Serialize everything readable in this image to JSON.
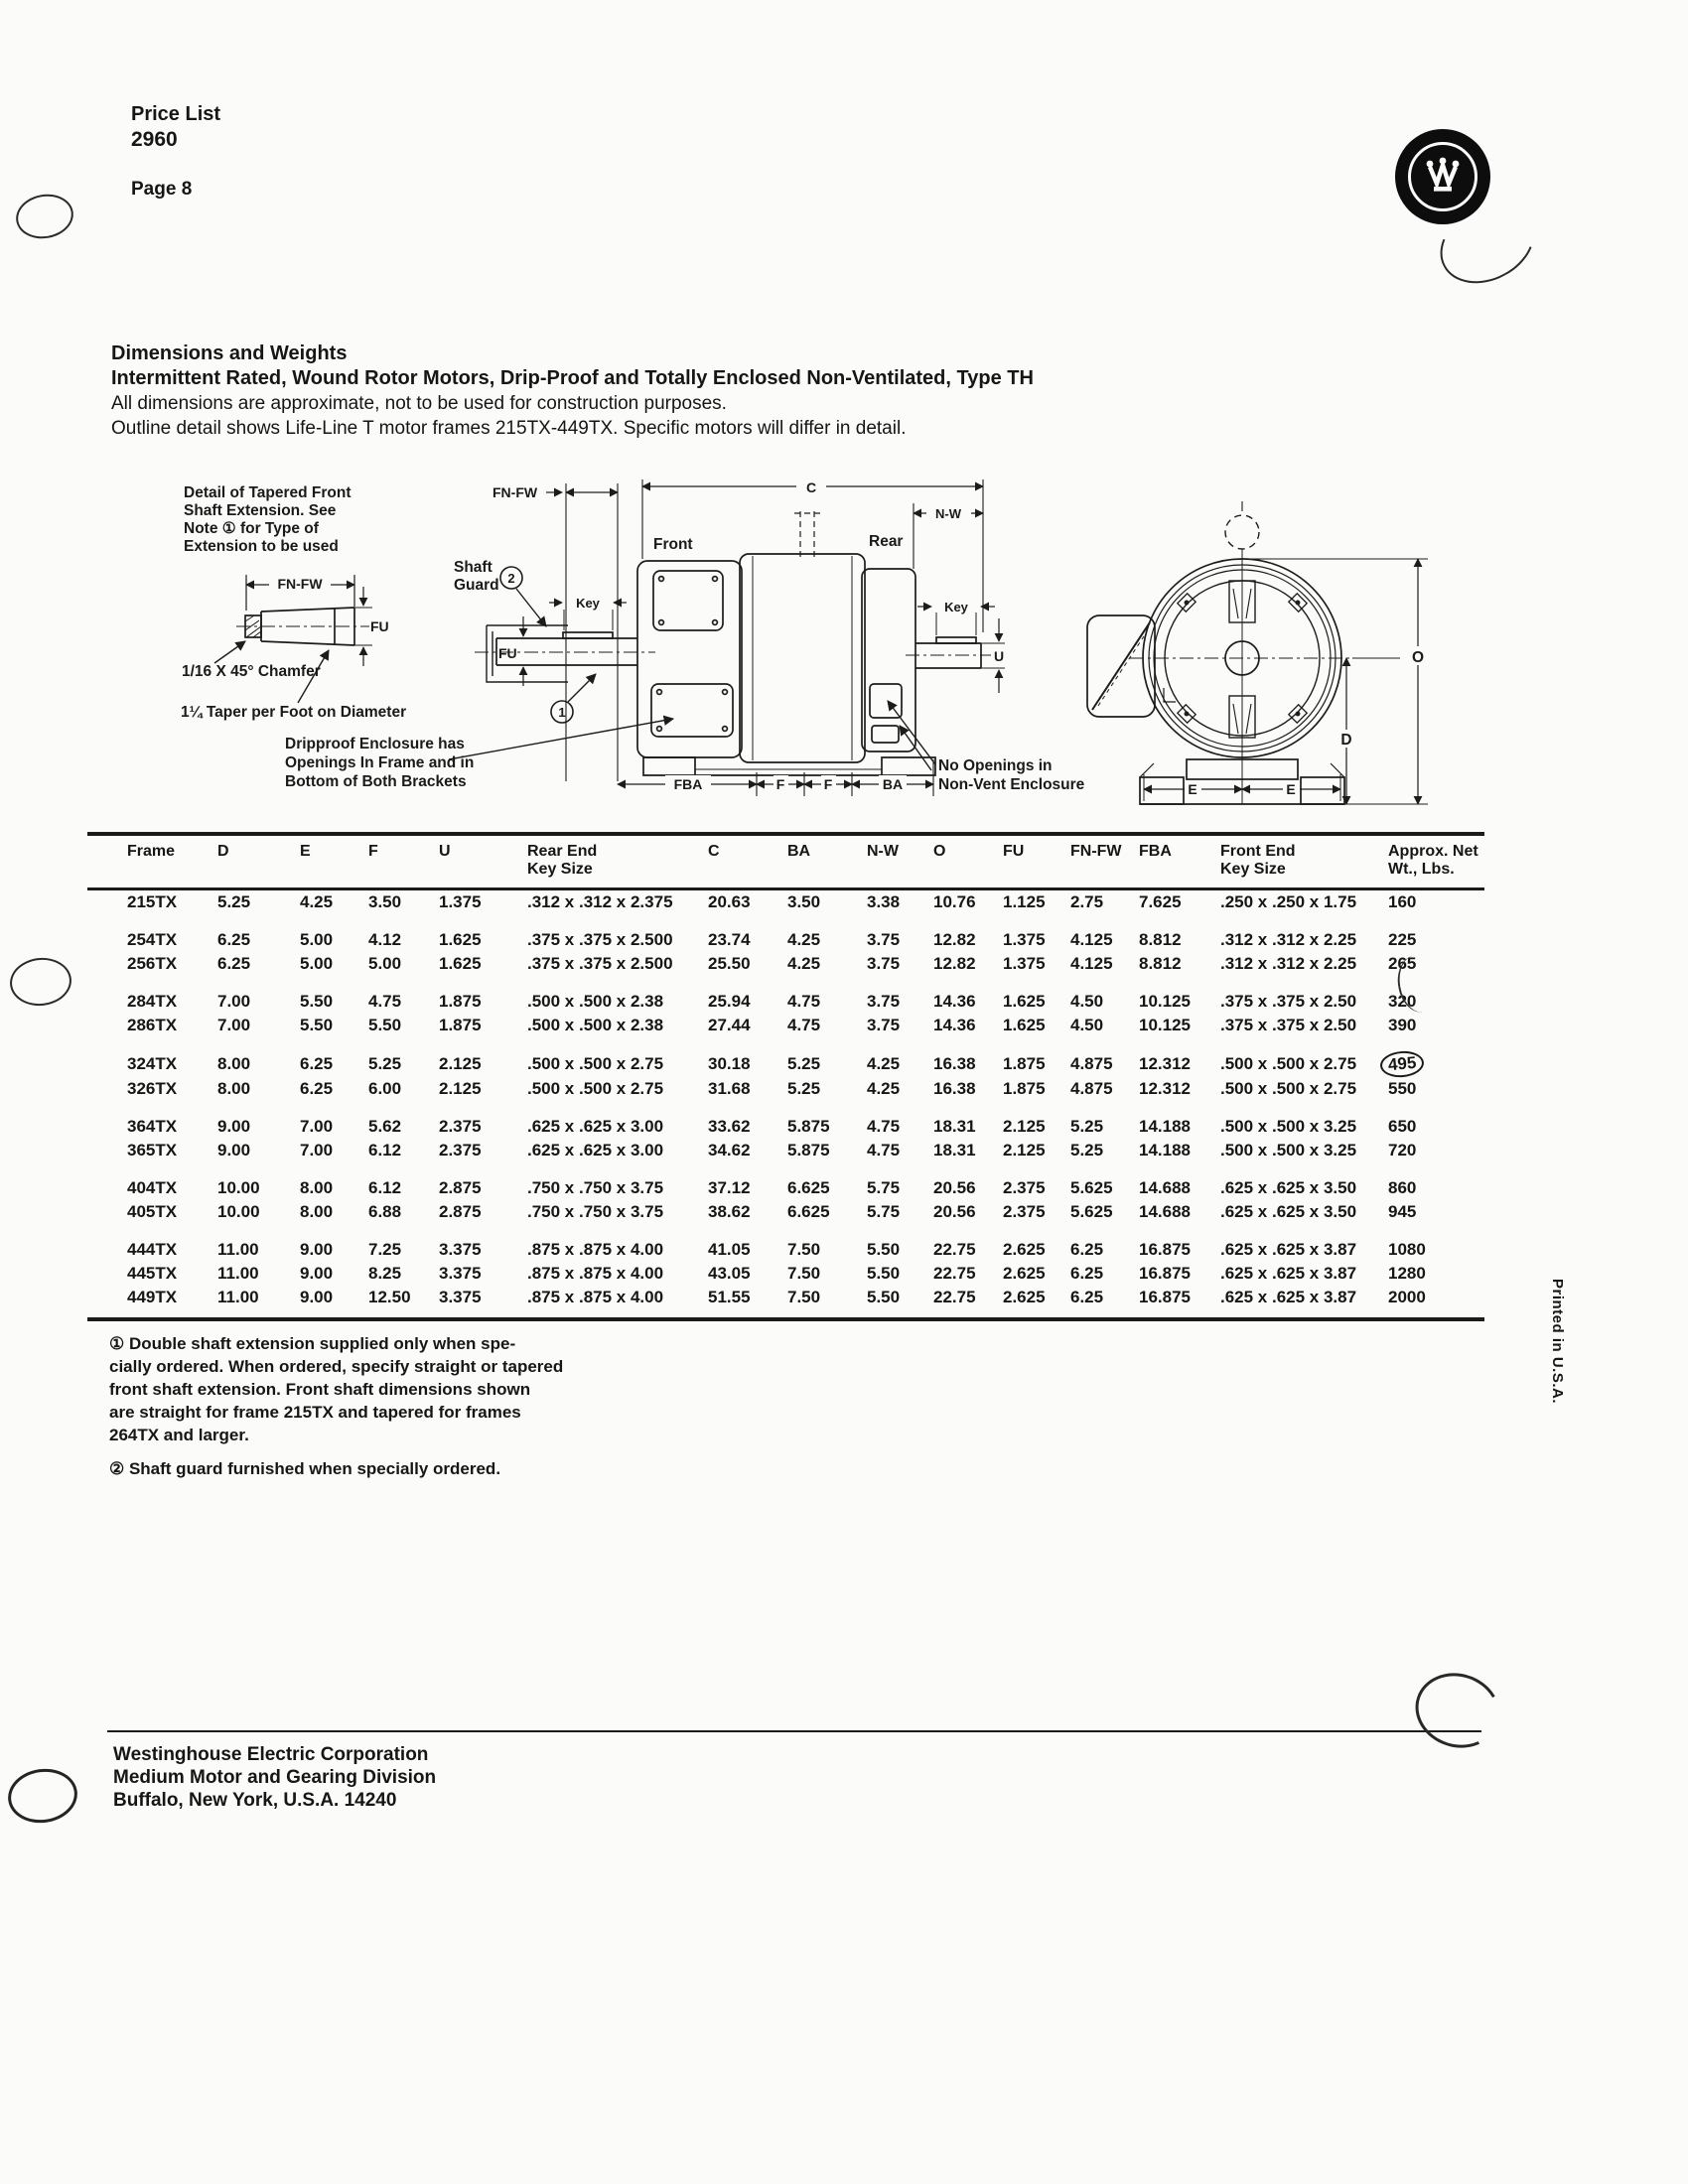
{
  "page": {
    "price_list_label": "Price List",
    "price_list_number": "2960",
    "page_label": "Page 8",
    "printed_in": "Printed in U.S.A."
  },
  "title": {
    "line1": "Dimensions and Weights",
    "line2": "Intermittent Rated, Wound Rotor Motors, Drip-Proof and Totally Enclosed Non-Ventilated, Type TH",
    "line3": "All dimensions are approximate, not to be used for construction purposes.",
    "line4": "Outline detail shows Life-Line T motor frames 215TX-449TX. Specific motors will differ in detail."
  },
  "diagram": {
    "detail_lines": [
      "Detail of Tapered Front",
      "Shaft Extension. See",
      "Note ① for Type of",
      "Extension to be used"
    ],
    "fn_fw_detail": "FN-FW",
    "fu_detail": "FU",
    "chamfer": "1/16 X 45° Chamfer",
    "taper": "1¼ Taper per Foot on Diameter",
    "shaft_guard_line1": "Shaft",
    "shaft_guard_line2": "Guard",
    "circle1": "1",
    "circle2": "2",
    "fn_fw_mid": "FN-FW",
    "c_dim": "C",
    "n_w_dim": "N-W",
    "front_label": "Front",
    "rear_label": "Rear",
    "key_front": "Key",
    "key_rear": "Key",
    "fu_mid": "FU",
    "u_dim": "U",
    "dripproof_lines": [
      "Dripproof Enclosure has",
      "Openings In Frame and in",
      "Bottom of Both Brackets"
    ],
    "no_openings_lines": [
      "No Openings in",
      "Non-Vent Enclosure"
    ],
    "fba_dim": "FBA",
    "f_dim1": "F",
    "f_dim2": "F",
    "ba_dim": "BA",
    "e_dim_left": "E",
    "e_dim_right": "E",
    "o_dim": "O",
    "d_dim": "D"
  },
  "table": {
    "columns": [
      [
        "Frame"
      ],
      [
        "D"
      ],
      [
        "E"
      ],
      [
        "F"
      ],
      [
        "U"
      ],
      [
        "Rear End",
        "Key Size"
      ],
      [
        "C"
      ],
      [
        "BA"
      ],
      [
        "N-W"
      ],
      [
        "O"
      ],
      [
        "FU"
      ],
      [
        "FN-FW"
      ],
      [
        "FBA"
      ],
      [
        "Front End",
        "Key Size"
      ],
      [
        "Approx. Net",
        "Wt., Lbs."
      ]
    ],
    "groups": [
      [
        [
          "215TX",
          "5.25",
          "4.25",
          "3.50",
          "1.375",
          ".312 x .312 x 2.375",
          "20.63",
          "3.50",
          "3.38",
          "10.76",
          "1.125",
          "2.75",
          "7.625",
          ".250 x .250 x 1.75",
          "160"
        ]
      ],
      [
        [
          "254TX",
          "6.25",
          "5.00",
          "4.12",
          "1.625",
          ".375 x .375 x 2.500",
          "23.74",
          "4.25",
          "3.75",
          "12.82",
          "1.375",
          "4.125",
          "8.812",
          ".312 x .312 x 2.25",
          "225"
        ],
        [
          "256TX",
          "6.25",
          "5.00",
          "5.00",
          "1.625",
          ".375 x .375 x 2.500",
          "25.50",
          "4.25",
          "3.75",
          "12.82",
          "1.375",
          "4.125",
          "8.812",
          ".312 x .312 x 2.25",
          "265"
        ]
      ],
      [
        [
          "284TX",
          "7.00",
          "5.50",
          "4.75",
          "1.875",
          ".500 x .500 x 2.38",
          "25.94",
          "4.75",
          "3.75",
          "14.36",
          "1.625",
          "4.50",
          "10.125",
          ".375 x .375 x 2.50",
          "320"
        ],
        [
          "286TX",
          "7.00",
          "5.50",
          "5.50",
          "1.875",
          ".500 x .500 x 2.38",
          "27.44",
          "4.75",
          "3.75",
          "14.36",
          "1.625",
          "4.50",
          "10.125",
          ".375 x .375 x 2.50",
          "390"
        ]
      ],
      [
        [
          "324TX",
          "8.00",
          "6.25",
          "5.25",
          "2.125",
          ".500 x .500 x 2.75",
          "30.18",
          "5.25",
          "4.25",
          "16.38",
          "1.875",
          "4.875",
          "12.312",
          ".500 x .500 x 2.75",
          "495"
        ],
        [
          "326TX",
          "8.00",
          "6.25",
          "6.00",
          "2.125",
          ".500 x .500 x 2.75",
          "31.68",
          "5.25",
          "4.25",
          "16.38",
          "1.875",
          "4.875",
          "12.312",
          ".500 x .500 x 2.75",
          "550"
        ]
      ],
      [
        [
          "364TX",
          "9.00",
          "7.00",
          "5.62",
          "2.375",
          ".625 x .625 x 3.00",
          "33.62",
          "5.875",
          "4.75",
          "18.31",
          "2.125",
          "5.25",
          "14.188",
          ".500 x .500 x 3.25",
          "650"
        ],
        [
          "365TX",
          "9.00",
          "7.00",
          "6.12",
          "2.375",
          ".625 x .625 x 3.00",
          "34.62",
          "5.875",
          "4.75",
          "18.31",
          "2.125",
          "5.25",
          "14.188",
          ".500 x .500 x 3.25",
          "720"
        ]
      ],
      [
        [
          "404TX",
          "10.00",
          "8.00",
          "6.12",
          "2.875",
          ".750 x .750 x 3.75",
          "37.12",
          "6.625",
          "5.75",
          "20.56",
          "2.375",
          "5.625",
          "14.688",
          ".625 x .625 x 3.50",
          "860"
        ],
        [
          "405TX",
          "10.00",
          "8.00",
          "6.88",
          "2.875",
          ".750 x .750 x 3.75",
          "38.62",
          "6.625",
          "5.75",
          "20.56",
          "2.375",
          "5.625",
          "14.688",
          ".625 x .625 x 3.50",
          "945"
        ]
      ],
      [
        [
          "444TX",
          "11.00",
          "9.00",
          "7.25",
          "3.375",
          ".875 x .875 x 4.00",
          "41.05",
          "7.50",
          "5.50",
          "22.75",
          "2.625",
          "6.25",
          "16.875",
          ".625 x .625 x 3.87",
          "1080"
        ],
        [
          "445TX",
          "11.00",
          "9.00",
          "8.25",
          "3.375",
          ".875 x .875 x 4.00",
          "43.05",
          "7.50",
          "5.50",
          "22.75",
          "2.625",
          "6.25",
          "16.875",
          ".625 x .625 x 3.87",
          "1280"
        ],
        [
          "449TX",
          "11.00",
          "9.00",
          "12.50",
          "3.375",
          ".875 x .875 x 4.00",
          "51.55",
          "7.50",
          "5.50",
          "22.75",
          "2.625",
          "6.25",
          "16.875",
          ".625 x .625 x 3.87",
          "2000"
        ]
      ]
    ],
    "circled_weight": "495"
  },
  "notes": {
    "note1": "① Double shaft extension supplied only when spe-\ncially ordered. When ordered, specify straight or tapered\nfront shaft extension. Front shaft dimensions shown\nare straight for frame 215TX and tapered for frames\n264TX and larger.",
    "note2": "② Shaft guard furnished when specially ordered."
  },
  "footer": {
    "line1": "Westinghouse Electric Corporation",
    "line2": "Medium Motor and Gearing Division",
    "line3": "Buffalo, New York, U.S.A. 14240"
  }
}
